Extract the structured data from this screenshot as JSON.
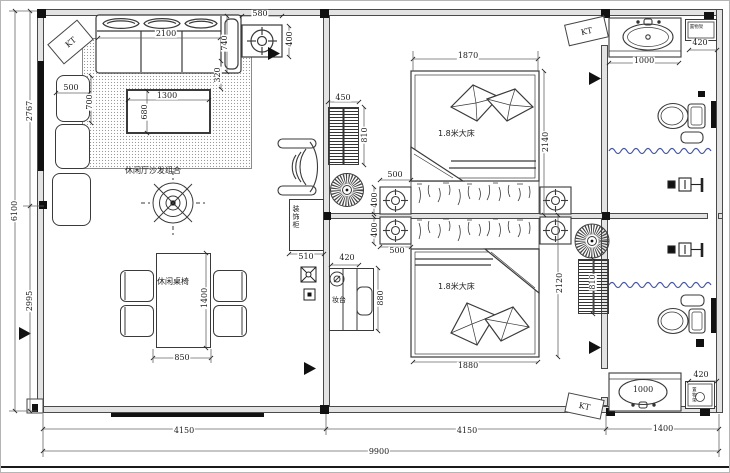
{
  "labels": {
    "kt": "KT",
    "sofa_area": "休闲厅沙发组合",
    "dining": "休闲桌椅",
    "cabinet": "装饰柜",
    "dresser": "妆台",
    "bed_top": "1.8米大床",
    "bed_bottom": "1.8米大床",
    "shelf_top": "置物架",
    "shelf_bottom": "置物架"
  },
  "icons": {
    "ceiling_fan": "circle-with-radial-blades",
    "downlight": "square-with-concentric-circles",
    "chandelier": "concentric-circles-with-spokes",
    "shower_head": "square-with-arm-symbol",
    "toilet": "oval-bowl-with-tank",
    "wash_basin": "oval-in-counter",
    "direction_marker": "filled-right-triangle",
    "outlet": "square-with-cross"
  },
  "colors": {
    "line": "#3a3a3a",
    "wall_fill": "#e3e3e3",
    "curtain_wave": "#4656a0",
    "marker": "#111111"
  },
  "dimensions": [
    {
      "text": "2100",
      "x": 165,
      "y": 33,
      "rot": 0
    },
    {
      "text": "740",
      "x": 224,
      "y": 42,
      "rot": -90
    },
    {
      "text": "580",
      "x": 259,
      "y": 13,
      "rot": 0
    },
    {
      "text": "400",
      "x": 289,
      "y": 38,
      "rot": -90
    },
    {
      "text": "320",
      "x": 217,
      "y": 74,
      "rot": -90
    },
    {
      "text": "500",
      "x": 70,
      "y": 87,
      "rot": 0
    },
    {
      "text": "700",
      "x": 89,
      "y": 101,
      "rot": -90
    },
    {
      "text": "1300",
      "x": 166,
      "y": 95,
      "rot": 0
    },
    {
      "text": "680",
      "x": 144,
      "y": 111,
      "rot": -90
    },
    {
      "text": "850",
      "x": 181,
      "y": 357,
      "rot": 0
    },
    {
      "text": "1400",
      "x": 204,
      "y": 297,
      "rot": -90
    },
    {
      "text": "450",
      "x": 342,
      "y": 97,
      "rot": 0
    },
    {
      "text": "810",
      "x": 364,
      "y": 134,
      "rot": -90
    },
    {
      "text": "500",
      "x": 394,
      "y": 174,
      "rot": 0
    },
    {
      "text": "400",
      "x": 374,
      "y": 199,
      "rot": -90
    },
    {
      "text": "400",
      "x": 374,
      "y": 229,
      "rot": -90
    },
    {
      "text": "500",
      "x": 396,
      "y": 250,
      "rot": 0
    },
    {
      "text": "510",
      "x": 305,
      "y": 256,
      "rot": 0
    },
    {
      "text": "420",
      "x": 346,
      "y": 257,
      "rot": 0
    },
    {
      "text": "880",
      "x": 380,
      "y": 297,
      "rot": -90
    },
    {
      "text": "1870",
      "x": 467,
      "y": 55,
      "rot": 0
    },
    {
      "text": "2140",
      "x": 545,
      "y": 141,
      "rot": -90
    },
    {
      "text": "1880",
      "x": 467,
      "y": 365,
      "rot": 0
    },
    {
      "text": "2120",
      "x": 559,
      "y": 282,
      "rot": -90
    },
    {
      "text": "810",
      "x": 592,
      "y": 281,
      "rot": -90
    },
    {
      "text": "1000",
      "x": 643,
      "y": 60,
      "rot": 0
    },
    {
      "text": "420",
      "x": 699,
      "y": 42,
      "rot": 0
    },
    {
      "text": "1000",
      "x": 642,
      "y": 389,
      "rot": 0
    },
    {
      "text": "420",
      "x": 700,
      "y": 374,
      "rot": 0
    },
    {
      "text": "4150",
      "x": 183,
      "y": 430,
      "rot": 0
    },
    {
      "text": "4150",
      "x": 466,
      "y": 430,
      "rot": 0
    },
    {
      "text": "1400",
      "x": 662,
      "y": 428,
      "rot": 0
    },
    {
      "text": "9900",
      "x": 378,
      "y": 451,
      "rot": 0
    },
    {
      "text": "6100",
      "x": 14,
      "y": 210,
      "rot": -90
    },
    {
      "text": "2767",
      "x": 29,
      "y": 110,
      "rot": -90
    },
    {
      "text": "2995",
      "x": 29,
      "y": 300,
      "rot": -90
    }
  ]
}
